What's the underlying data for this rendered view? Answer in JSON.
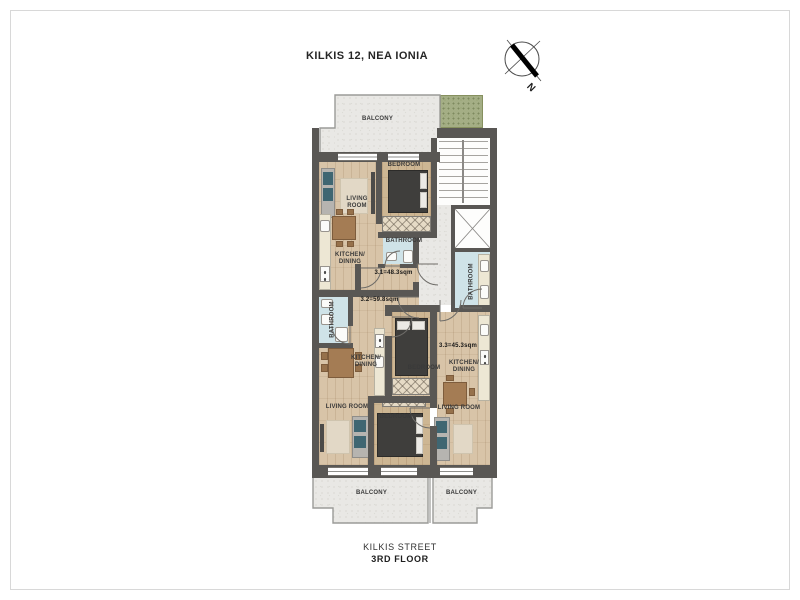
{
  "title": "KILKIS 12, NEA IONIA",
  "compass": {
    "north_label": "N"
  },
  "plan": {
    "balcony_top": "BALCONY",
    "balcony_bottom_left": "BALCONY",
    "balcony_bottom_right": "BALCONY",
    "apartment_31": {
      "area": "3.1=48.3sqm",
      "living_room": "LIVING ROOM",
      "bedroom": "BEDROOM",
      "kitchen": "KITCHEN/ DINING",
      "bathroom": "BATHROOM"
    },
    "apartment_32": {
      "area": "3.2=59.8sqm",
      "living_room": "LIVING ROOM",
      "bedroom": "BEDROOM",
      "kitchen": "KITCHEN/ DINING",
      "bathroom": "BATHROOM"
    },
    "apartment_33": {
      "area": "3.3=45.3sqm",
      "living_room": "LIVING ROOM",
      "bedroom": "BEDROOM",
      "kitchen": "KITCHEN/ DINING",
      "bathroom": "BATHROOM"
    }
  },
  "footer": {
    "street": "KILKIS STREET",
    "floor": "3RD FLOOR"
  },
  "colors": {
    "wall": "#595754",
    "wood_floor": "#d8c4a8",
    "bathroom_floor": "#cfe3e8",
    "balcony_floor": "#e9e8e5",
    "planter_green": "#a4ae85",
    "sofa_accent": "#3f6672"
  }
}
